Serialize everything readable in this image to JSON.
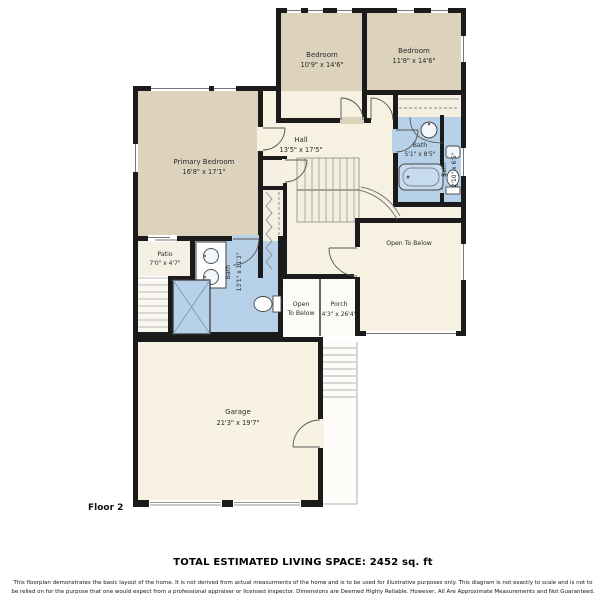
{
  "floorplan": {
    "floor_label": "Floor 2",
    "rooms": {
      "bedroom_a": {
        "name": "Bedroom",
        "dims": "10'9\" x 14'6\""
      },
      "bedroom_b": {
        "name": "Bedroom",
        "dims": "11'8\" x 14'6\""
      },
      "primary_bedroom": {
        "name": "Primary Bedroom",
        "dims": "16'8\" x 17'1\""
      },
      "hall": {
        "name": "Hall",
        "dims": "13'5\" x 17'5\""
      },
      "bath_hall": {
        "name": "Bath",
        "dims": "5'1\" x 8'5\""
      },
      "bath_corner": {
        "name": "Bath",
        "dims": "2'10\" x 6'5\""
      },
      "open_to_below_large": {
        "name": "Open To Below"
      },
      "patio": {
        "name": "Patio",
        "dims": "7'0\" x 4'7\""
      },
      "bath_primary": {
        "name": "Bath",
        "dims": "13'1\" x 11'3\""
      },
      "open_to_below_small": {
        "line1": "Open",
        "line2": "To Below"
      },
      "porch": {
        "name": "Porch",
        "dims": "4'3\" x 26'4\""
      },
      "garage": {
        "name": "Garage",
        "dims": "21'3\" x 19'7\""
      }
    },
    "colors": {
      "bedroom_fill": "#ddd3bd",
      "hall_fill": "#f6f1e1",
      "bath_fill": "#b7d1e8",
      "wall": "#1b1b1b"
    }
  },
  "footer": {
    "total_living_space": "TOTAL ESTIMATED LIVING SPACE: 2452 sq. ft",
    "disclaimer_line1": "This floorplan demonstrates the basic layout of the home. It is not derived from actual measurments of the home and is to be used for illustrative purposes only. This diagram is not exactly to scale and is not to",
    "disclaimer_line2": "be relied on for the purpose that one would expect from a professional appraiser or licensed inspector. Dimensions are Deemed Highly Reliable. However, All Are Approximate Measurements and Not Guaranteed."
  }
}
